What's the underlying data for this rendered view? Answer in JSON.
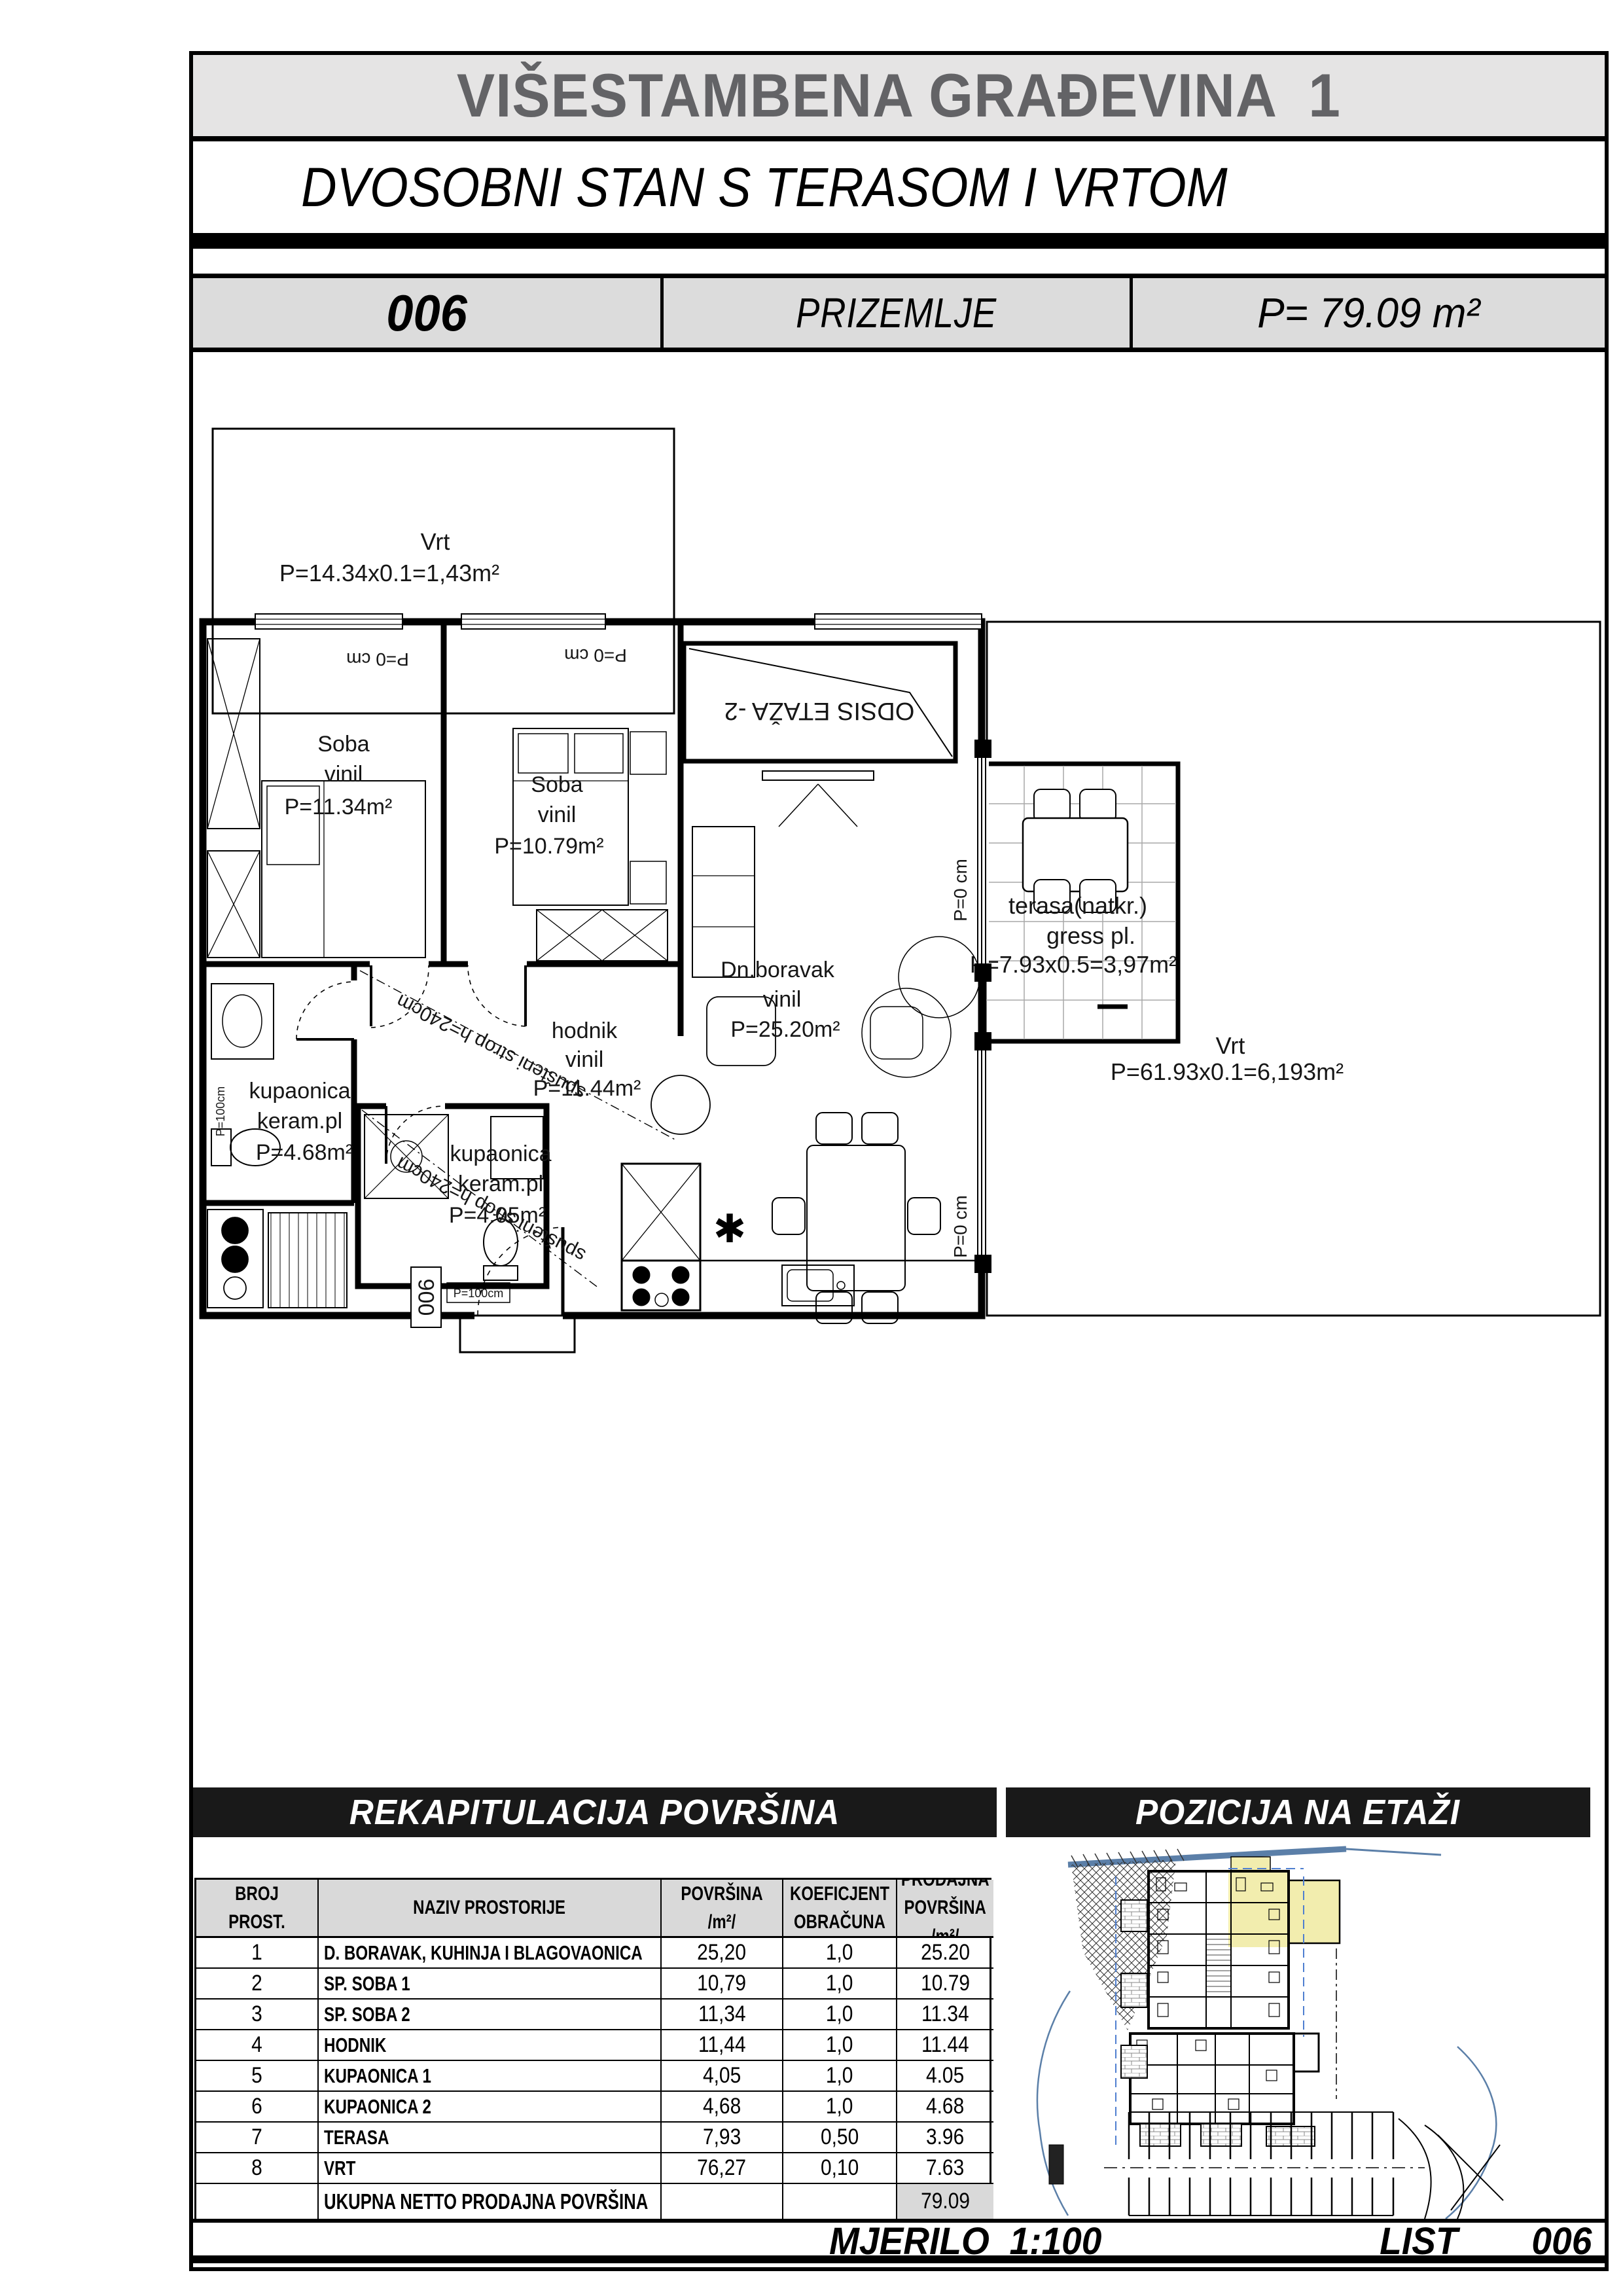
{
  "page": {
    "title": "VIŠESTAMBENA GRAĐEVINA  1",
    "subtitle": "DVOSOBNI STAN S TERASOM I VRTOM",
    "unit_number": "006",
    "floor": "PRIZEMLJE",
    "area": "P= 79.09 m²"
  },
  "plan": {
    "garden_top": {
      "name": "Vrt",
      "calc": "P=14.34x0.1=1,43m²"
    },
    "bedroom1": {
      "name": "Soba",
      "floor": "vinil",
      "area": "P=11.34m²"
    },
    "bedroom2": {
      "name": "Soba",
      "floor": "vinil",
      "area": "P=10.79m²"
    },
    "hall": {
      "name": "hodnik",
      "floor": "vinil",
      "area": "P=11.44m²"
    },
    "bath1": {
      "name": "kupaonica",
      "floor": "keram.pl",
      "area": "P=4.68m²"
    },
    "bath2": {
      "name": "kupaonica",
      "floor": "keram.pl",
      "area": "P=4.05m²"
    },
    "living": {
      "name": "Dn.boravak",
      "floor": "vinil",
      "area": "P=25.20m²"
    },
    "terrace": {
      "name": "terasa(natkr.)",
      "floor": "gress pl.",
      "calc": "P=7.93x0.5=3,97m²"
    },
    "garden_right": {
      "name": "Vrt",
      "calc": "P=61.93x0.1=6,193m²"
    },
    "stair_label": "ODSIS ETAŽA -2",
    "ceiling_note": "spušteni strop h=240cm",
    "zero_height": "P=0 cm",
    "window_height": "P=100cm",
    "entry_label": "006"
  },
  "recap": {
    "title": "REKAPITULACIJA POVRŠINA",
    "position_title": "POZICIJA NA ETAŽI",
    "columns": {
      "c1": "BROJ PROST.",
      "c2": "NAZIV PROSTORIJE",
      "c3": "POVRŠINA  /m²/",
      "c4": "KOEFICJENT\nOBRAČUNA",
      "c5": "PRODAJNA\nPOVRŠINA /m²/"
    },
    "rows": [
      {
        "num": "1",
        "name": "D. BORAVAK, KUHINJA I BLAGOVAONICA",
        "area": "25,20",
        "coef": "1,0",
        "sale": "25.20"
      },
      {
        "num": "2",
        "name": "SP. SOBA 1",
        "area": "10,79",
        "coef": "1,0",
        "sale": "10.79"
      },
      {
        "num": "3",
        "name": "SP. SOBA 2",
        "area": "11,34",
        "coef": "1,0",
        "sale": "11.34"
      },
      {
        "num": "4",
        "name": "HODNIK",
        "area": "11,44",
        "coef": "1,0",
        "sale": "11.44"
      },
      {
        "num": "5",
        "name": "KUPAONICA 1",
        "area": "4,05",
        "coef": "1,0",
        "sale": "4.05"
      },
      {
        "num": "6",
        "name": "KUPAONICA 2",
        "area": "4,68",
        "coef": "1,0",
        "sale": "4.68"
      },
      {
        "num": "7",
        "name": "TERASA",
        "area": "7,93",
        "coef": "0,50",
        "sale": "3.96"
      },
      {
        "num": "8",
        "name": "VRT",
        "area": "76,27",
        "coef": "0,10",
        "sale": "7.63"
      }
    ],
    "total_label": "UKUPNA NETTO PRODAJNA POVRŠINA",
    "total_value": "79.09"
  },
  "footer": {
    "scale_label": "MJERILO  1:100",
    "sheet_label": "LIST",
    "sheet_number": "006"
  },
  "colors": {
    "highlight": "#f2edae",
    "site_line": "#5b7fa8",
    "bar_bg": "#191919",
    "header_gray": "#d9d9d9",
    "title_gray": "#e5e4e4"
  }
}
